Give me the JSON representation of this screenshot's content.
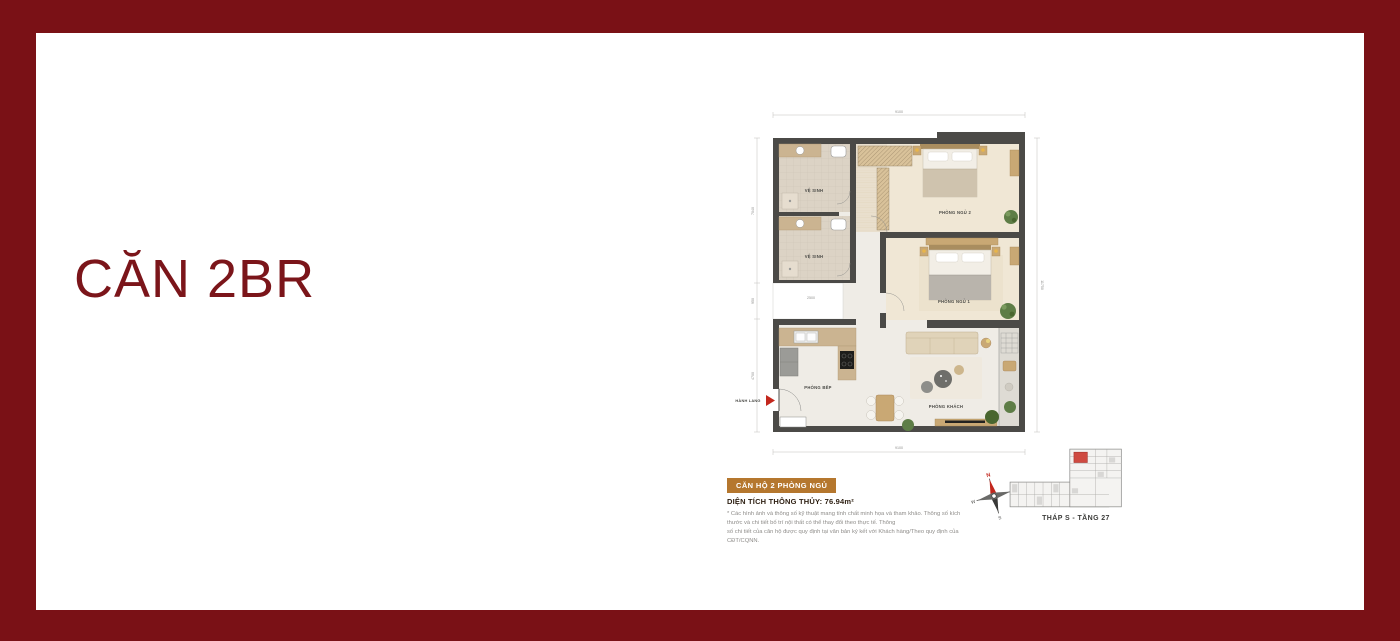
{
  "page": {
    "title": "CĂN 2BR"
  },
  "colors": {
    "frame": "#7a1116",
    "title": "#7b151a",
    "badge": "#b5772e",
    "accent_red": "#c3271d",
    "wall": "#4b4a47"
  },
  "floorplan": {
    "rooms": {
      "bath1": "VỆ SINH",
      "bath2": "VỆ SINH",
      "bedroom2": "PHÒNG NGỦ 2",
      "bedroom1": "PHÒNG NGỦ 1",
      "kitchen": "PHÒNG BẾP",
      "living": "PHÒNG KHÁCH"
    },
    "entrance": "HÀNH LANG",
    "dims": {
      "top": "9100",
      "bottom": "9100",
      "right": "11750",
      "left_upper": "7040",
      "left_mid": "950",
      "left_lower": "4700",
      "niche": "2500"
    }
  },
  "info": {
    "badge": "CĂN HỘ 2 PHÒNG NGỦ",
    "area": "DIỆN TÍCH THÔNG THỦY: 76.94m²",
    "disclaimer1": "* Các hình ảnh và thông số kỹ thuật mang tính chất minh họa và tham khảo. Thông số kích thước và chi tiết bố trí nội thất có thể thay đổi theo thực tế. Thông",
    "disclaimer2": "số chi tiết của căn hộ được quy định tại văn bản ký kết với Khách hàng/Theo quy định của CĐT/CQNN."
  },
  "locator": {
    "caption": "THÁP S - TẦNG 27"
  },
  "compass": {
    "n": "N",
    "e": "E",
    "s": "S",
    "w": "W"
  }
}
